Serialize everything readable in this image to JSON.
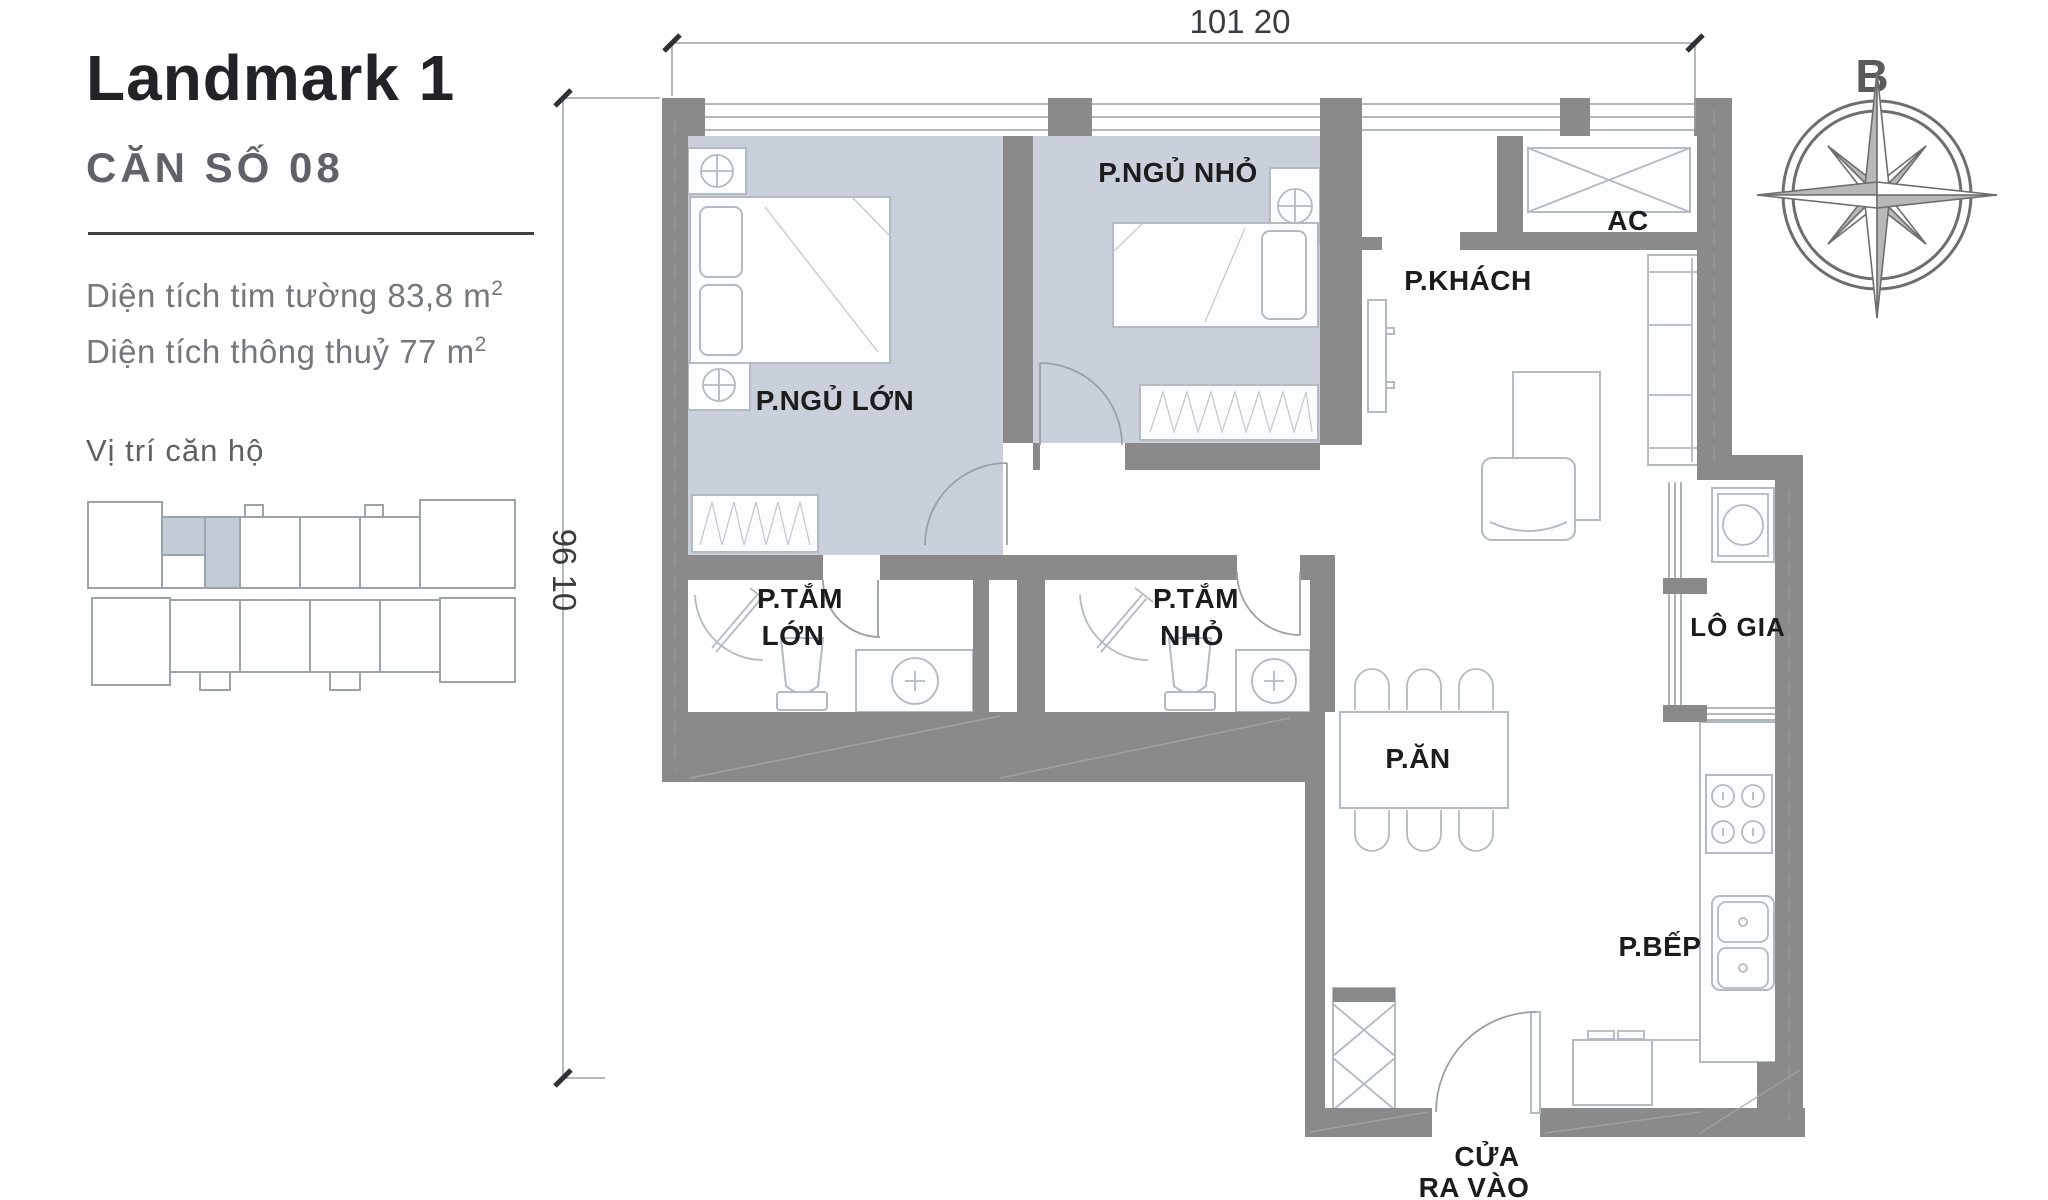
{
  "panel": {
    "title": "Landmark 1",
    "unit_label": "CĂN SỐ 08",
    "area_line1": "Diện tích tim tường 83,8 m",
    "area_line2": "Diện tích thông thuỷ 77 m",
    "area_sup": "2",
    "location_title": "Vị trí căn hộ"
  },
  "dimensions": {
    "top": "101 20",
    "left": "96 10"
  },
  "compass": {
    "north_label": "B"
  },
  "rooms": {
    "bedroom_small": "P.NGỦ NHỎ",
    "bedroom_master": "P.NGỦ LỚN",
    "living": "P.KHÁCH",
    "ac_closet": "AC",
    "bath_master_line1": "P.TẮM",
    "bath_master_line2": "LỚN",
    "bath_small_line1": "P.TẮM",
    "bath_small_line2": "NHỎ",
    "dining": "P.ĂN",
    "loggia": "LÔ GIA",
    "kitchen": "P.BẾP",
    "entrance_line1": "CỬA",
    "entrance_line2": "RA VÀO"
  },
  "colors": {
    "wall": "#8a8a8a",
    "bedroom_fill": "#c9d0d9",
    "furniture_stroke": "#b3bac2",
    "label_text": "#1c1c1c",
    "muted_text": "#74787d",
    "unit_highlight": "#c3cbd6"
  }
}
